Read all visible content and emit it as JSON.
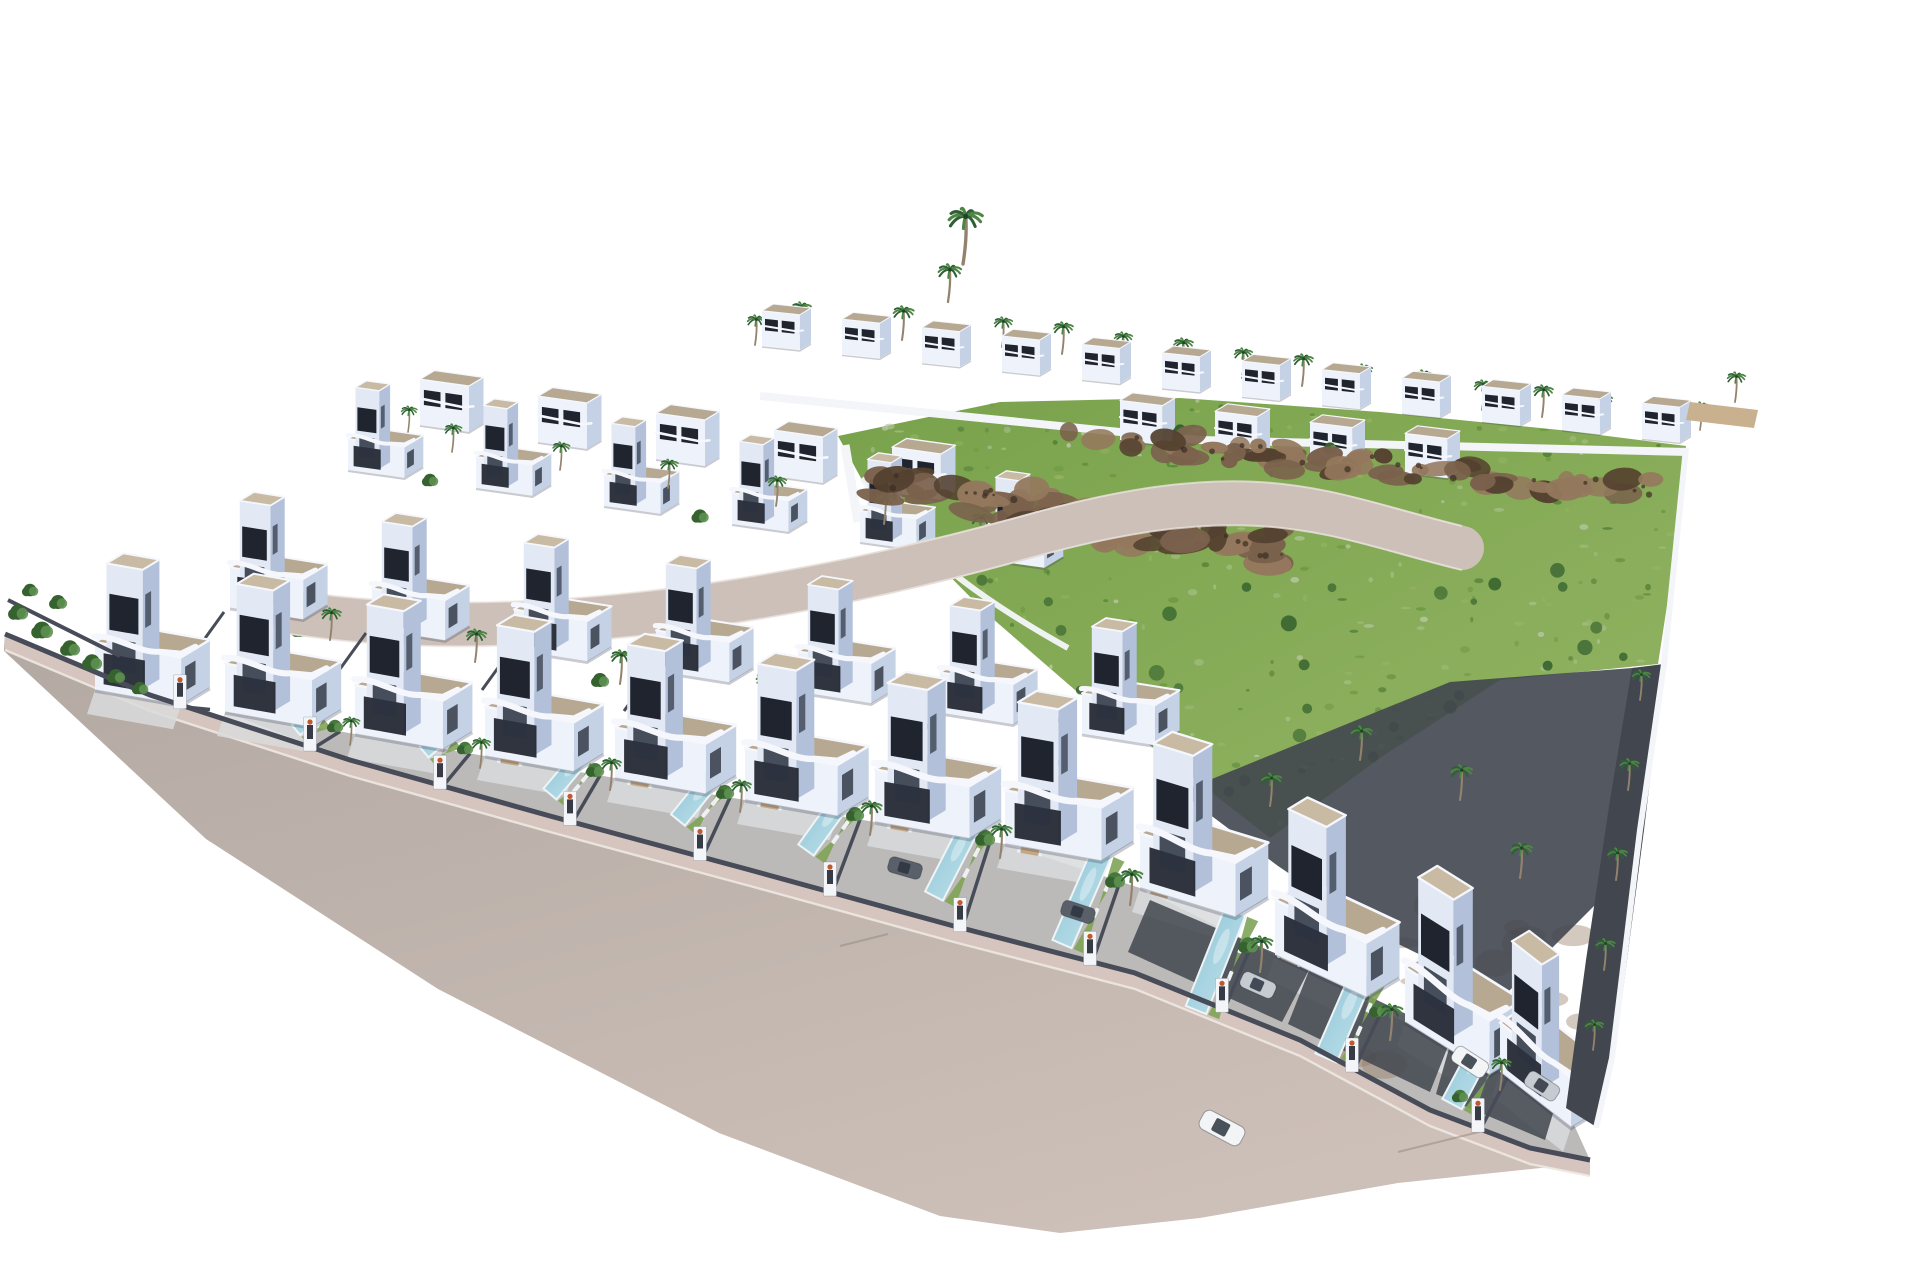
{
  "scene": {
    "title": "Aerial 3D render of a modern white villa development with private pools, palm trees, a rocky green hillside plot and a curving access road",
    "width": 1920,
    "height": 1280,
    "background": "#ffffff"
  },
  "palette": {
    "villaLit": "#eef2fa",
    "villaFace": "#e2e9f5",
    "villaShade": "#c5d1e5",
    "villaShade2": "#b2c1d9",
    "roof": "#b7a892",
    "roofLight": "#c8baa3",
    "parapet": "#f5f7fc",
    "window": "#1f242e",
    "windowSoft": "#2c3340",
    "fence": "#474c58",
    "fenceDark": "#363b45",
    "road": "#b3a9a3",
    "roadLight": "#cdc0b8",
    "sidewalk": "#d5c5be",
    "curb": "#eee8e2",
    "yard": "#bcbab8",
    "terrace": "#d9dadc",
    "lawn": "#7fa457",
    "pool": "#8fc4d6",
    "poolLight": "#c2e3ec",
    "poolRim": "#eef4f6",
    "grass": "#79a24c",
    "grassLight": "#93b463",
    "grassPale": "#b7c6a0",
    "grassDark": "#527f36",
    "grassDeep": "#6d9840",
    "rock": "#7a614c",
    "rockLight": "#94785d",
    "rockDark": "#54412f",
    "soil": "#9a8267",
    "frond": "#2f5f36",
    "frondLight": "#4d8544",
    "trunk": "#93836d",
    "palmCore": "#1f4527",
    "shrub": "#47783d",
    "shrubDark": "#35622e",
    "shrubLight": "#5d9050",
    "carWhite": "#f2f4f6",
    "carSilver": "#c6cbd1",
    "carGray": "#596069",
    "carGlass": "#2c343f",
    "flower": "#c05a2d",
    "wallWhite": "#f3f5f9",
    "gravel": "#41464f",
    "shadow": "rgba(40,48,66,0.25)"
  },
  "road": {
    "wall_line": [
      [
        5,
        634
      ],
      [
        150,
        695
      ],
      [
        350,
        760
      ],
      [
        550,
        816
      ],
      [
        750,
        870
      ],
      [
        950,
        925
      ],
      [
        1135,
        973
      ],
      [
        1300,
        1040
      ],
      [
        1430,
        1110
      ],
      [
        1530,
        1148
      ],
      [
        1590,
        1160
      ]
    ],
    "outer_edge": [
      [
        4,
        651
      ],
      [
        206,
        839
      ],
      [
        438,
        989
      ],
      [
        719,
        1133
      ],
      [
        940,
        1216
      ],
      [
        1060,
        1233
      ],
      [
        1200,
        1218
      ],
      [
        1398,
        1183
      ],
      [
        1560,
        1166
      ],
      [
        1586,
        1170
      ]
    ],
    "sidewalk_width": 16,
    "seams": [
      [
        840,
        946,
        888,
        934
      ],
      [
        1398,
        1152,
        1495,
        1128
      ]
    ]
  },
  "villa_base_line": [
    [
      40,
      676
    ],
    [
      95,
      690
    ],
    [
      225,
      712
    ],
    [
      355,
      734
    ],
    [
      485,
      756
    ],
    [
      615,
      778
    ],
    [
      745,
      800
    ],
    [
      875,
      822
    ],
    [
      1005,
      844
    ],
    [
      1140,
      888
    ],
    [
      1275,
      955
    ],
    [
      1405,
      1022
    ],
    [
      1500,
      1072
    ],
    [
      1565,
      1105
    ]
  ],
  "hillside": {
    "polygon": [
      [
        838,
        436
      ],
      [
        1000,
        402
      ],
      [
        1180,
        398
      ],
      [
        1380,
        412
      ],
      [
        1560,
        430
      ],
      [
        1686,
        446
      ],
      [
        1674,
        560
      ],
      [
        1658,
        664
      ],
      [
        1500,
        680
      ],
      [
        1380,
        758
      ],
      [
        1270,
        838
      ],
      [
        1170,
        760
      ],
      [
        1075,
        690
      ],
      [
        985,
        612
      ],
      [
        912,
        538
      ],
      [
        862,
        480
      ]
    ],
    "seed": 1234,
    "speckle_count": 260,
    "shrub_dot_count": 30,
    "rock_bands": [
      {
        "from": [
          880,
          482
        ],
        "to": [
          1280,
          550
        ],
        "count": 52,
        "spread": 36,
        "rx": [
          10,
          26
        ],
        "ry": [
          6,
          14
        ]
      },
      {
        "from": [
          1060,
          435
        ],
        "to": [
          1645,
          492
        ],
        "count": 58,
        "spread": 24,
        "rx": [
          8,
          22
        ],
        "ry": [
          5,
          12
        ]
      }
    ],
    "rock_dot_count": 40,
    "soil_patch": {
      "cx": 1470,
      "cy": 990,
      "rx": 130,
      "ry": 85,
      "count": 18
    },
    "edge_wall_path": "M 862,478 C 920,560 1000,610 1068,648",
    "step_walls": [
      "M 845,445 L 858,522",
      "M 882,455 L 898,540"
    ]
  },
  "walls": {
    "ridge_wall_path": "M 760,396 L 1200,440 L 1688,452",
    "right_wall_path": "M 1686,448 L 1664,664 L 1640,830 L 1612,1058 L 1596,1128",
    "right_gravel": [
      [
        1664,
        664
      ],
      [
        1644,
        830
      ],
      [
        1614,
        1060
      ],
      [
        1598,
        1128
      ],
      [
        1566,
        1108
      ],
      [
        1586,
        960
      ],
      [
        1610,
        800
      ],
      [
        1632,
        668
      ]
    ],
    "back_gravel": [
      [
        1180,
        792
      ],
      [
        1450,
        682
      ],
      [
        1658,
        666
      ],
      [
        1634,
        866
      ],
      [
        1504,
        996
      ],
      [
        1382,
        936
      ],
      [
        1278,
        866
      ]
    ],
    "corner_deck": [
      [
        1690,
        402
      ],
      [
        1758,
        410
      ],
      [
        1754,
        428
      ],
      [
        1686,
        420
      ]
    ],
    "left_fence": [
      [
        8,
        600
      ],
      [
        120,
        656
      ]
    ]
  },
  "internal_road": {
    "center": "M 290,612 C 520,648 800,600 1030,536 S 1330,516 1462,548",
    "edges": [
      "M 290,590 C 520,626 800,578 1030,514 S 1330,494 1462,526",
      "M 290,634 C 520,670 800,622 1030,558 S 1330,538 1462,570"
    ],
    "width": 44
  },
  "villa_rows": [
    {
      "name": "ridge-row",
      "x0": 762,
      "y0": 346,
      "dx": 80,
      "dy": 8.4,
      "n": 12,
      "s": 0.4,
      "rot": 6,
      "type": "small"
    },
    {
      "name": "back-row-left",
      "x0": 420,
      "y0": 425,
      "dx": 118,
      "dy": 17,
      "n": 5,
      "s": 0.52,
      "rot": 8,
      "type": "small"
    },
    {
      "name": "back-row-right",
      "x0": 1120,
      "y0": 440,
      "dx": 95,
      "dy": 11,
      "n": 4,
      "s": 0.45,
      "rot": 7,
      "type": "small"
    },
    {
      "name": "second-row",
      "x0": 348,
      "y0": 470,
      "dx": 128,
      "dy": 18,
      "n": 6,
      "s": 0.6,
      "rot": 8,
      "type": "full"
    },
    {
      "name": "third-row",
      "x0": 230,
      "y0": 608,
      "dx": 142,
      "dy": 21,
      "n": 7,
      "s": 0.78,
      "rot": 9,
      "type": "full"
    }
  ],
  "front_villas": [
    [
      95,
      690,
      0.92,
      10
    ],
    [
      225,
      712,
      0.93,
      10
    ],
    [
      355,
      734,
      0.94,
      10
    ],
    [
      485,
      756,
      0.95,
      10
    ],
    [
      615,
      778,
      0.97,
      10
    ],
    [
      745,
      800,
      0.99,
      10
    ],
    [
      875,
      822,
      1.01,
      10
    ],
    [
      1005,
      844,
      1.03,
      10
    ],
    [
      1140,
      888,
      1.05,
      17
    ],
    [
      1275,
      955,
      1.06,
      25
    ],
    [
      1405,
      1022,
      1.05,
      32
    ],
    [
      1500,
      1072,
      0.95,
      38
    ]
  ],
  "front_lots": {
    "boundaries_x": [
      180,
      310,
      440,
      570,
      700,
      830,
      960,
      1090,
      1222,
      1352,
      1478
    ],
    "pools": [
      [
        318,
        712,
        296,
        730,
        13
      ],
      [
        448,
        732,
        424,
        752,
        14
      ],
      [
        582,
        756,
        550,
        794,
        17
      ],
      [
        712,
        778,
        678,
        820,
        18
      ],
      [
        842,
        800,
        806,
        850,
        19
      ],
      [
        972,
        822,
        934,
        896,
        20
      ],
      [
        1102,
        852,
        1062,
        944,
        21
      ],
      [
        1235,
        912,
        1196,
        1010,
        22
      ],
      [
        1362,
        975,
        1326,
        1058,
        23
      ],
      [
        1486,
        1040,
        1452,
        1104,
        22
      ]
    ],
    "lounger_pools": [
      2,
      3,
      4,
      5,
      6,
      7,
      8
    ],
    "dining": [
      [
        510,
        760,
        9
      ],
      [
        640,
        782,
        9
      ],
      [
        770,
        804,
        10
      ],
      [
        900,
        826,
        10
      ],
      [
        1030,
        850,
        10
      ],
      [
        1160,
        892,
        16
      ],
      [
        1290,
        958,
        24
      ]
    ],
    "gravel_pads": [
      [
        [
          1150,
          900
        ],
        [
          1310,
          968
        ],
        [
          1282,
          1022
        ],
        [
          1128,
          952
        ]
      ],
      [
        [
          1310,
          968
        ],
        [
          1452,
          1036
        ],
        [
          1430,
          1092
        ],
        [
          1288,
          1024
        ]
      ],
      [
        [
          1452,
          1038
        ],
        [
          1560,
          1090
        ],
        [
          1545,
          1140
        ],
        [
          1436,
          1094
        ]
      ]
    ],
    "cars_in_lots": [
      [
        905,
        868,
        16,
        34,
        16,
        "carGray"
      ],
      [
        1078,
        912,
        18,
        34,
        16,
        "carGray"
      ],
      [
        1258,
        985,
        24,
        36,
        17,
        "carSilver"
      ]
    ]
  },
  "street_cars": [
    [
      1470,
      1062,
      33,
      38,
      18,
      "carWhite"
    ],
    [
      1542,
      1086,
      33,
      36,
      17,
      "carSilver"
    ],
    [
      1222,
      1128,
      28,
      46,
      21,
      "carWhite"
    ]
  ],
  "palms": {
    "ridge": [
      [
        755,
        345,
        0.75
      ],
      [
        800,
        334,
        0.8
      ],
      [
        852,
        346,
        0.7
      ],
      [
        902,
        340,
        0.85
      ],
      [
        948,
        302,
        0.95
      ],
      [
        963,
        264,
        1.4
      ],
      [
        1002,
        347,
        0.75
      ],
      [
        1062,
        354,
        0.8
      ],
      [
        1122,
        362,
        0.75
      ],
      [
        1182,
        370,
        0.8
      ],
      [
        1242,
        378,
        0.75
      ],
      [
        1302,
        386,
        0.8
      ],
      [
        1362,
        394,
        0.75
      ],
      [
        1422,
        402,
        0.8
      ],
      [
        1482,
        410,
        0.75
      ],
      [
        1542,
        417,
        0.8
      ],
      [
        1602,
        424,
        0.75
      ],
      [
        1657,
        431,
        0.8
      ],
      [
        1700,
        430,
        0.7
      ],
      [
        1735,
        402,
        0.75
      ]
    ],
    "cluster": [
      [
        452,
        452,
        0.7
      ],
      [
        560,
        470,
        0.7
      ],
      [
        668,
        488,
        0.72
      ],
      [
        776,
        506,
        0.75
      ],
      [
        884,
        524,
        0.78
      ],
      [
        980,
        545,
        0.8
      ],
      [
        408,
        432,
        0.65
      ]
    ],
    "mid": [
      [
        330,
        640,
        0.8
      ],
      [
        475,
        662,
        0.82
      ],
      [
        620,
        684,
        0.85
      ],
      [
        765,
        706,
        0.85
      ],
      [
        910,
        728,
        0.88
      ],
      [
        1055,
        752,
        0.9
      ]
    ],
    "front": [
      [
        350,
        745,
        0.7
      ],
      [
        480,
        768,
        0.75
      ],
      [
        610,
        790,
        0.8
      ],
      [
        740,
        812,
        0.8
      ],
      [
        870,
        835,
        0.85
      ],
      [
        1000,
        858,
        0.85
      ],
      [
        1130,
        905,
        0.9
      ],
      [
        1260,
        972,
        0.9
      ],
      [
        1390,
        1040,
        0.9
      ],
      [
        1500,
        1090,
        0.8
      ]
    ],
    "right_strip": [
      [
        1640,
        700,
        0.75
      ],
      [
        1628,
        790,
        0.78
      ],
      [
        1616,
        880,
        0.8
      ],
      [
        1604,
        970,
        0.78
      ],
      [
        1593,
        1050,
        0.75
      ]
    ],
    "back_zone": [
      [
        1360,
        760,
        0.85
      ],
      [
        1460,
        800,
        0.88
      ],
      [
        1520,
        878,
        0.88
      ],
      [
        1270,
        806,
        0.82
      ]
    ]
  },
  "shrubs": {
    "left_corner": [
      [
        18,
        612,
        1.1
      ],
      [
        42,
        630,
        1.2
      ],
      [
        70,
        648,
        1.1
      ],
      [
        30,
        590,
        0.9
      ],
      [
        58,
        602,
        1.0
      ],
      [
        92,
        662,
        1.1
      ],
      [
        116,
        676,
        1.0
      ],
      [
        140,
        688,
        0.9
      ]
    ],
    "lots": [
      [
        335,
        726,
        0.9
      ],
      [
        465,
        748,
        0.9
      ],
      [
        595,
        770,
        1.0
      ],
      [
        725,
        792,
        1.0
      ],
      [
        855,
        814,
        1.0
      ],
      [
        985,
        838,
        1.1
      ],
      [
        1115,
        880,
        1.1
      ],
      [
        1248,
        945,
        1.1
      ],
      [
        1378,
        1010,
        1.0
      ],
      [
        1460,
        1096,
        0.9
      ]
    ],
    "rows": [
      [
        430,
        480,
        0.9
      ],
      [
        700,
        516,
        0.95
      ],
      [
        950,
        560,
        0.9
      ],
      [
        300,
        630,
        1.0
      ],
      [
        600,
        680,
        1.0
      ],
      [
        900,
        732,
        1.0
      ],
      [
        1180,
        430,
        0.8
      ],
      [
        1330,
        448,
        0.8
      ]
    ]
  }
}
